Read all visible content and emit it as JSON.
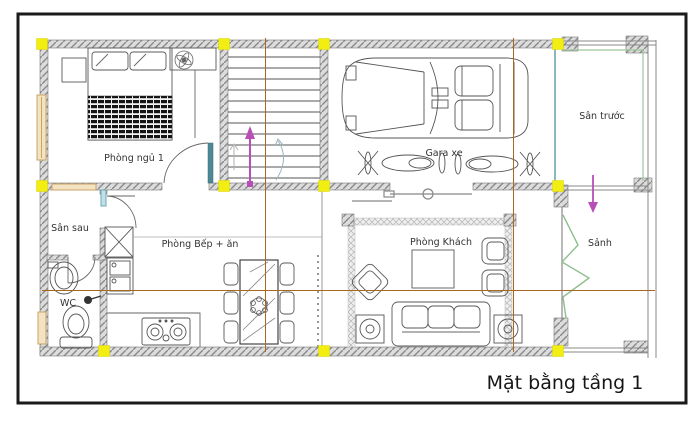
{
  "title": "Mặt bằng tầng 1",
  "rooms": {
    "bedroom1": "Phòng ngủ 1",
    "back_yard": "Sân sau",
    "wc": "WC",
    "kitchen_dining": "Phòng Bếp + ăn",
    "garage": "Gara xe",
    "front_yard": "Sân trước",
    "living_room": "Phòng Khách",
    "hall": "Sảnh"
  },
  "colors": {
    "frame": "#1a1a1a",
    "wall_fill": "#dcdcdc",
    "wall_hatch": "#8a8a8a",
    "column_marker": "#f2ee12",
    "grid_line": "#a8691f",
    "direction_arrow": "#b84fb8",
    "door_leaf": "#4e8796",
    "boundary_line": "#8ab8c0",
    "folding_door": "#8fbf8f",
    "window_frame": "#c9a565"
  },
  "symbols": [
    "double-bed",
    "ceiling-fan",
    "nightstand",
    "staircase",
    "car",
    "motorbike",
    "dining-table",
    "chair",
    "kitchen-sink",
    "stove",
    "fridge-shaft",
    "toilet",
    "washbasin",
    "sofa",
    "armchair",
    "coffee-table",
    "speaker",
    "folding-door",
    "sliding-garage-door",
    "column-marker",
    "direction-arrow"
  ]
}
